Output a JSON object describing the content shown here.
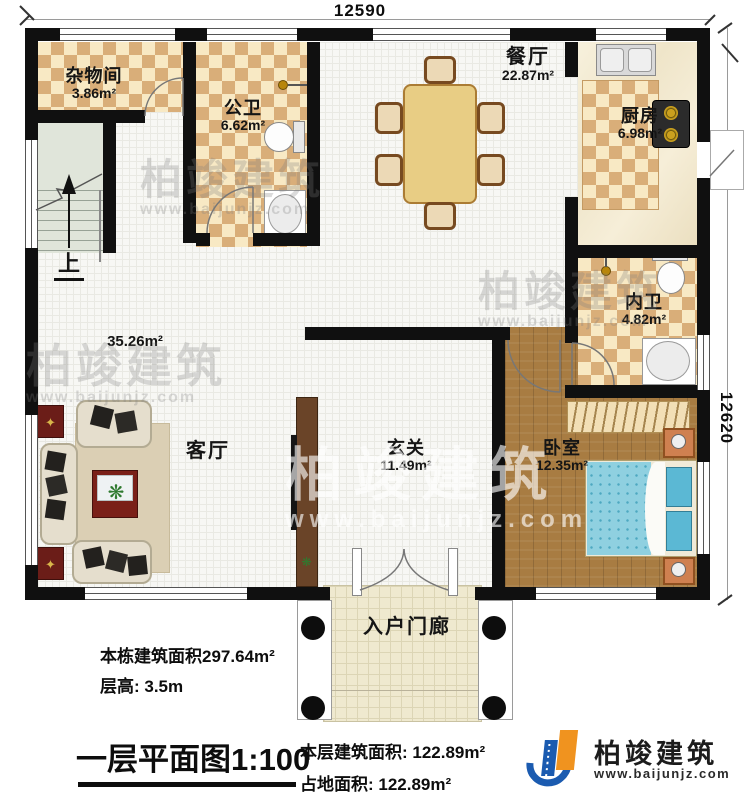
{
  "dimensions": {
    "top": "12590",
    "right": "12620"
  },
  "rooms": {
    "storage": {
      "name": "杂物间",
      "area": "3.86m²"
    },
    "public_bath": {
      "name": "公卫",
      "area": "6.62m²"
    },
    "dining": {
      "name": "餐厅",
      "area": "22.87m²"
    },
    "kitchen": {
      "name": "厨房",
      "area": "6.98m²"
    },
    "ensuite_bath": {
      "name": "内卫",
      "area": "4.82m²"
    },
    "living": {
      "name": "客厅",
      "area": "35.26m²"
    },
    "foyer": {
      "name": "玄关",
      "area": "11.49m²"
    },
    "bedroom": {
      "name": "卧室",
      "area": "12.35m²"
    },
    "porch": {
      "name": "入户门廊"
    },
    "stairs": {
      "direction_label": "上"
    }
  },
  "annotations": {
    "building_total_area": "本栋建筑面积297.64m²",
    "floor_height": "层高: 3.5m",
    "plan_title": "一层平面图1:100",
    "floor_area": "本层建筑面积: 122.89m²",
    "footprint_area": "占地面积: 122.89m²"
  },
  "brand": {
    "name": "柏竣建筑",
    "website": "www.baijunjz.com"
  },
  "watermark": {
    "text": "柏竣建筑",
    "url": "www.baijunjz.com"
  },
  "colors": {
    "wall": "#101010",
    "checker_light": "#f8e9c4",
    "checker_dark": "#d9ae79",
    "wood_floor": "#a87c42",
    "bed": "#8fd0e0",
    "logo_blue": "#1b5bb0",
    "logo_orange": "#f0931f"
  }
}
